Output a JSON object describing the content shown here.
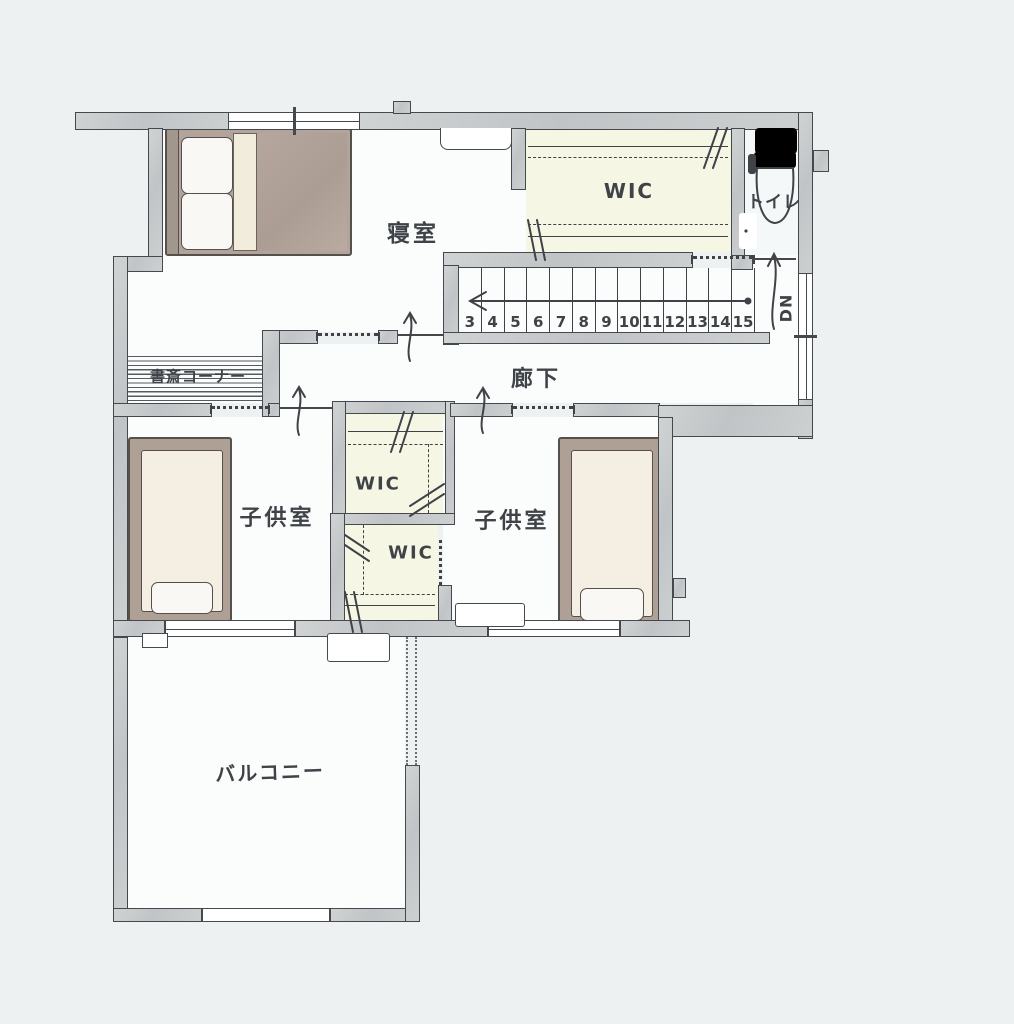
{
  "rooms": {
    "bedroom": "寝室",
    "wic_main": "WIC",
    "toilet": "トイレ",
    "hallway": "廊下",
    "study_corner": "書斎コーナー",
    "wic_upper": "WIC",
    "wic_lower": "WIC",
    "kids_room_left": "子供室",
    "kids_room_right": "子供室",
    "balcony": "バルコニー"
  },
  "stairs": {
    "step_numbers": [
      "3",
      "4",
      "5",
      "6",
      "7",
      "8",
      "9",
      "10",
      "11",
      "12",
      "13",
      "14",
      "15"
    ],
    "down_label": "DN"
  },
  "colors": {
    "wall_fill": "#c6c9ca",
    "outline": "#45494e",
    "wic_fill": "#f6f6e5",
    "bed_duvet": "#b2a49b",
    "bed_frame": "#afa096",
    "mattress": "#f5eee2",
    "background": "#eef1f2",
    "room_fill": "#fbfcfc"
  }
}
